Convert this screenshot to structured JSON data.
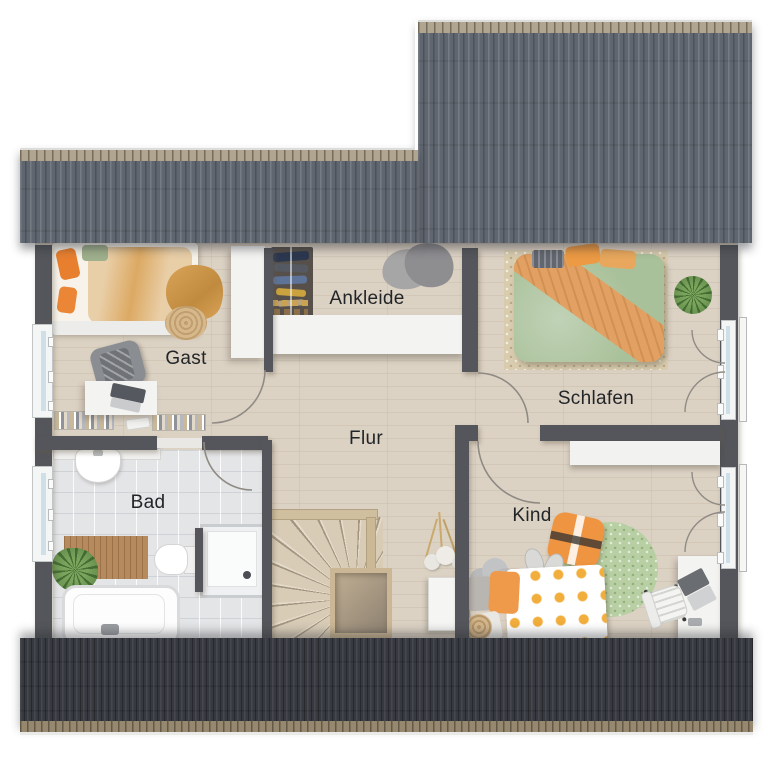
{
  "rooms": [
    {
      "id": "gast",
      "label": "Gast"
    },
    {
      "id": "ankleide",
      "label": "Ankleide"
    },
    {
      "id": "schlafen",
      "label": "Schlafen"
    },
    {
      "id": "flur",
      "label": "Flur"
    },
    {
      "id": "bad",
      "label": "Bad"
    },
    {
      "id": "kind",
      "label": "Kind"
    }
  ],
  "palette": {
    "roof_top": "#60666f",
    "roof_bottom": "#36393f",
    "ridge_cap": "#b0a591",
    "eave_cap": "#95886e",
    "wall": "#54565b",
    "floor_wood": "#dcd2c4",
    "floor_tile": "#e4e5e7",
    "accent_orange": "#ef9a3f",
    "accent_green": "#a9c39b",
    "label_color": "#222528",
    "window_glass": "#cfdfe7"
  }
}
